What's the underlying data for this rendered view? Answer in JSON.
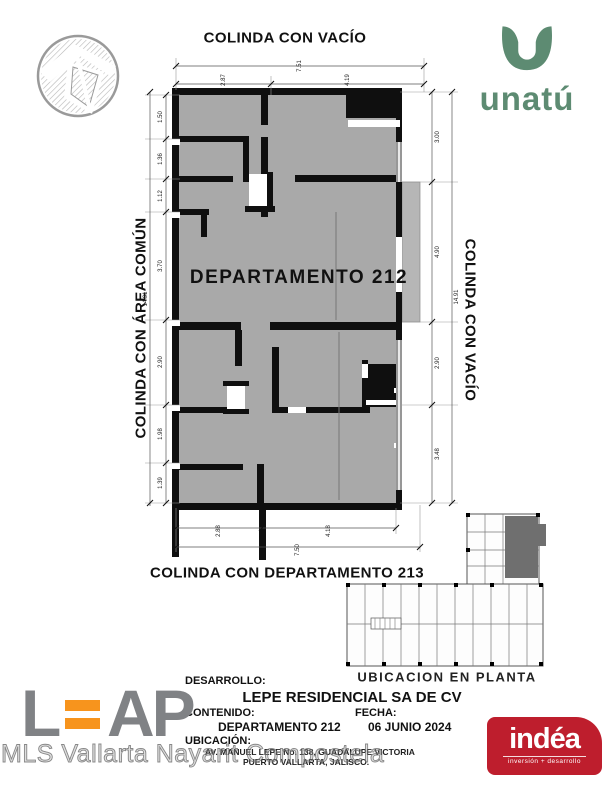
{
  "plan": {
    "unit_label": "DEPARTAMENTO  212",
    "boundary_top": "COLINDA CON VACÍO",
    "boundary_left": "COLINDA CON ÁREA COMÚN",
    "boundary_right": "COLINDA CON VACÍO",
    "boundary_bottom": "COLINDA CON DEPARTAMENTO 213",
    "dims": {
      "top": [
        "7.51",
        "2.87",
        "4.19"
      ],
      "left": [
        "1.50",
        "1.36",
        "1.12",
        "3.70",
        "14.91",
        "2.90",
        "1.98",
        "1.39"
      ],
      "right": [
        "3.00",
        "4.90",
        "14.91",
        "2.90",
        "3.48"
      ],
      "bottom": [
        "2.88",
        "4.18",
        "7.50"
      ]
    }
  },
  "location_plan": {
    "caption": "UBICACION EN PLANTA"
  },
  "title_block": {
    "desarrollo_label": "DESARROLLO:",
    "desarrollo": "LEPE RESIDENCIAL SA DE CV",
    "contenido_label": "CONTENIDO:",
    "contenido": "DEPARTAMENTO 212",
    "fecha_label": "FECHA:",
    "fecha": "06 JUNIO 2024",
    "ubicacion_label": "UBICACIÓN:",
    "ubicacion_line1": "AV. MANUEL LEPE No. 138, GUADALUPE VICTORIA",
    "ubicacion_line2": "PUERTO VALLARTA, JALISCO."
  },
  "logos": {
    "unatu": {
      "name": "unatú",
      "color": "#5d8b72"
    },
    "leap": {
      "part1": "L",
      "part2": "AP",
      "gray": "#808285",
      "orange": "#f7941d"
    },
    "indea": {
      "name": "indéa",
      "tagline": "inversión + desarrollo",
      "red": "#be1e2d"
    }
  },
  "watermark": {
    "text": "MLS Vallarta Nayarit Compostela"
  },
  "colors": {
    "plan_floor_fill": "#a9a9a9",
    "terrace_fill": "#b6b6b6",
    "wall_black": "#0f0f0f",
    "highlight_unit_gray": "#6f6f6f"
  }
}
